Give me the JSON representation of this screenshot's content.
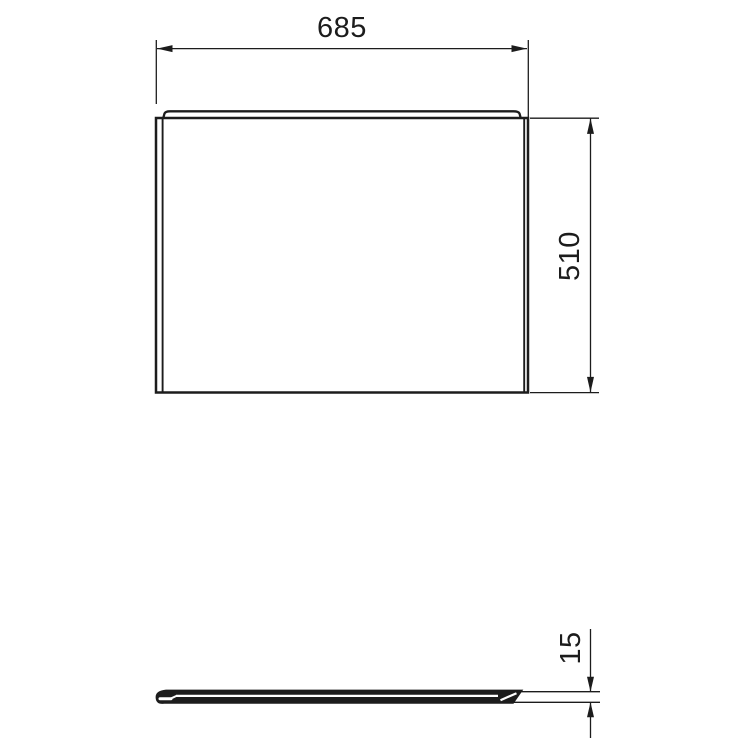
{
  "drawing": {
    "type": "technical-dimension-drawing",
    "background_color": "#ffffff",
    "line_color": "#1c1c1c",
    "views": {
      "front": "panel front elevation with top capping lip",
      "profile": "panel top/section view showing thickness"
    },
    "dimensions": {
      "width": {
        "label": "685",
        "orientation": "horizontal"
      },
      "height": {
        "label": "510",
        "orientation": "vertical"
      },
      "thickness": {
        "label": "15",
        "orientation": "vertical"
      }
    }
  }
}
